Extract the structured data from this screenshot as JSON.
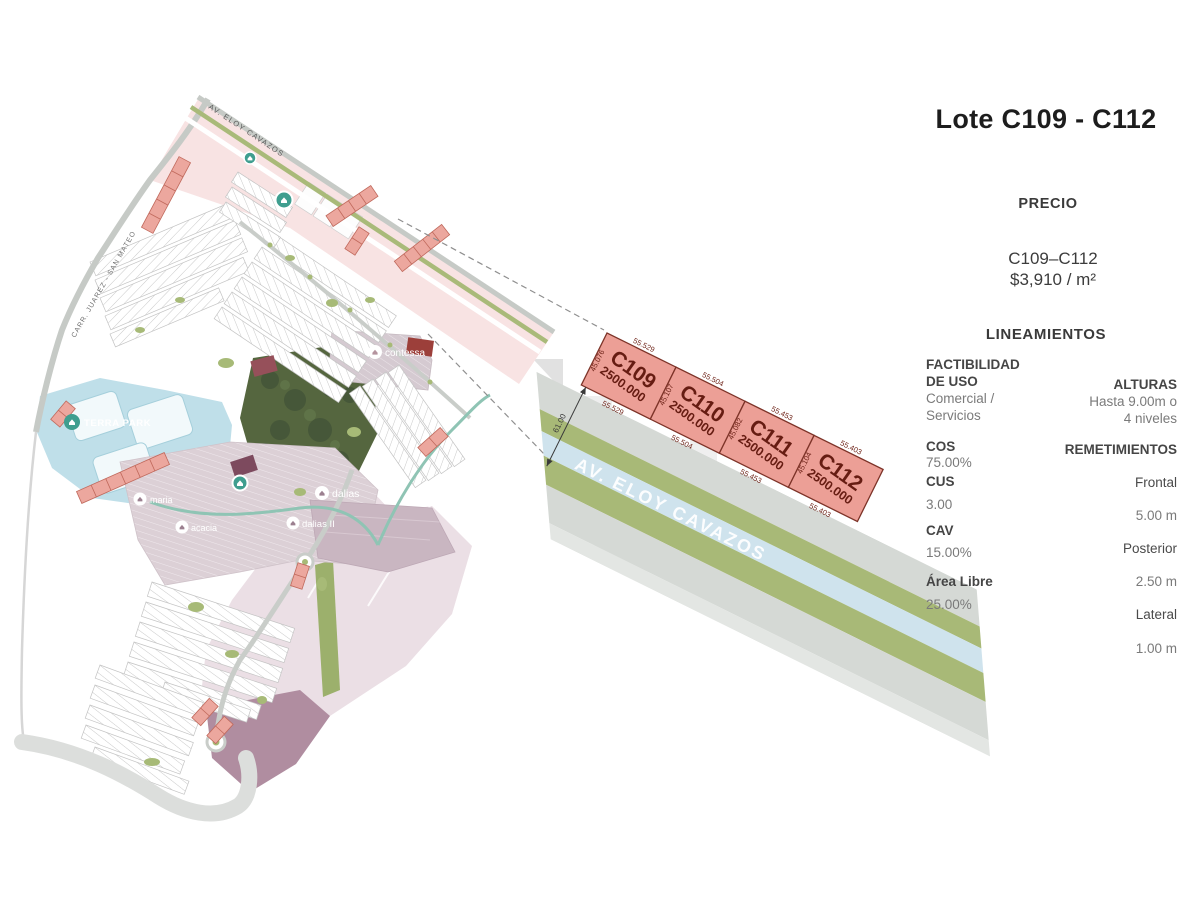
{
  "panel": {
    "title": "Lote C109 - C112",
    "precio_heading": "PRECIO",
    "precio_range": "C109–C112",
    "precio_value": "$3,910 / m²",
    "lineamientos_heading": "LINEAMIENTOS",
    "factibilidad_label1": "FACTIBILIDAD",
    "factibilidad_label2": "DE USO",
    "factibilidad_value1": "Comercial /",
    "factibilidad_value2": "Servicios",
    "cos_label": "COS",
    "cos_value": "75.00%",
    "cus_label": "CUS",
    "cus_value": "3.00",
    "cav_label": "CAV",
    "cav_value": "15.00%",
    "area_libre_label": "Área Libre",
    "area_libre_value": "25.00%",
    "alturas_label": "ALTURAS",
    "alturas_value1": "Hasta 9.00m o",
    "alturas_value2": "4 niveles",
    "remetimientos_label": "REMETIMIENTOS",
    "frontal_label": "Frontal",
    "frontal_value": "5.00 m",
    "posterior_label": "Posterior",
    "posterior_value": "2.50 m",
    "lateral_label": "Lateral",
    "lateral_value": "1.00 m"
  },
  "detail": {
    "street": "AV. ELOY CAVAZOS",
    "road_width_dim": "61.00",
    "lots": [
      {
        "id": "C109",
        "area": "2500.000",
        "front": "55.529",
        "side": "45.076",
        "back": "55.529"
      },
      {
        "id": "C110",
        "area": "2500.000",
        "front": "55.504",
        "side": "45.107",
        "back": "55.504"
      },
      {
        "id": "C111",
        "area": "2500.000",
        "front": "55.453",
        "side": "45.082",
        "back": "55.453"
      },
      {
        "id": "C112",
        "area": "2500.000",
        "front": "55.403",
        "side": "45.104",
        "back": "55.403"
      }
    ]
  },
  "map": {
    "street_top": "AV. ELOY CAVAZOS",
    "street_left": "CARR. JUAREZ - SAN MATEO",
    "labels": {
      "terra_park": "TERRA PARK",
      "contessa": "contessa",
      "maria": "maria",
      "acacia": "acacia",
      "dalias": "dalias",
      "dalias2": "dalias II"
    }
  },
  "colors": {
    "lot_fill": "#ec9f96",
    "lot_border": "#7d3328",
    "lot_text": "#661c12",
    "road_gray": "#d5d9d5",
    "road_green": "#a8b977",
    "road_blue": "#cfe3ed",
    "pink_strip": "#f8e3e3",
    "teal_park": "#bfdfe9",
    "dark_park_green": "#55663f",
    "mauve": "#dcd0d6"
  }
}
